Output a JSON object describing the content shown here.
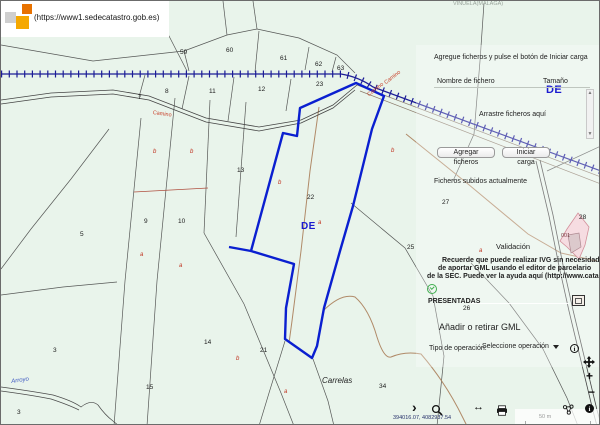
{
  "header": {
    "url": "(https://www1.sedecatastro.gob.es)",
    "area_label": "VIÑUELA(MALAGA)"
  },
  "upload_panel": {
    "instruction": "Agregue ficheros y pulse el botón de Iniciar carga",
    "file_table": {
      "name_header": "Nombre de fichero",
      "size_header": "Tamaño",
      "dropzone_text": "Arrastre ficheros aquí"
    },
    "add_files_button": "Agregar ficheros",
    "start_upload_button": "Iniciar carga",
    "uploaded_files_title": "Ficheros subidos actualmente",
    "validation_title": "Validación",
    "notice_lines": {
      "l1": "Recuerde que puede realizar IVG sin necesidad",
      "l2": "de aportar GML usando el editor de parcelario",
      "l3": "de la SEC. Puede ver la ayuda aquí (http://www.catastro.m"
    },
    "status_presented": "PRESENTADAS",
    "gml_section_title": "Añadir o retirar GML",
    "operation_type_label": "Tipo de operación:",
    "operation_select_value": "Seleccione operación"
  },
  "map": {
    "coordinates": "394016.07, 4082937.54",
    "scale_label": "50 m",
    "labels": [
      {
        "text": "59",
        "x": 179,
        "y": 49,
        "cls": "num"
      },
      {
        "text": "60",
        "x": 225,
        "y": 47,
        "cls": "num"
      },
      {
        "text": "61",
        "x": 279,
        "y": 55,
        "cls": "num"
      },
      {
        "text": "62",
        "x": 314,
        "y": 61,
        "cls": "num"
      },
      {
        "text": "63",
        "x": 336,
        "y": 65,
        "cls": "num"
      },
      {
        "text": "7",
        "x": 137,
        "y": 94,
        "cls": "num"
      },
      {
        "text": "8",
        "x": 164,
        "y": 88,
        "cls": "num"
      },
      {
        "text": "11",
        "x": 208,
        "y": 88,
        "cls": "num"
      },
      {
        "text": "12",
        "x": 257,
        "y": 86,
        "cls": "num"
      },
      {
        "text": "23",
        "x": 315,
        "y": 81,
        "cls": "num"
      },
      {
        "text": "13",
        "x": 236,
        "y": 167,
        "cls": "num"
      },
      {
        "text": "22",
        "x": 306,
        "y": 194,
        "cls": "num"
      },
      {
        "text": "9",
        "x": 143,
        "y": 218,
        "cls": "num"
      },
      {
        "text": "10",
        "x": 177,
        "y": 218,
        "cls": "num"
      },
      {
        "text": "5",
        "x": 79,
        "y": 231,
        "cls": "num"
      },
      {
        "text": "27",
        "x": 441,
        "y": 199,
        "cls": "num"
      },
      {
        "text": "25",
        "x": 406,
        "y": 244,
        "cls": "num"
      },
      {
        "text": "26",
        "x": 462,
        "y": 305,
        "cls": "num"
      },
      {
        "text": "28",
        "x": 578,
        "y": 214,
        "cls": "num"
      },
      {
        "text": "14",
        "x": 203,
        "y": 339,
        "cls": "num"
      },
      {
        "text": "15",
        "x": 145,
        "y": 384,
        "cls": "num"
      },
      {
        "text": "3",
        "x": 52,
        "y": 347,
        "cls": "num"
      },
      {
        "text": "3",
        "x": 16,
        "y": 409,
        "cls": "num"
      },
      {
        "text": "21",
        "x": 259,
        "y": 347,
        "cls": "num"
      },
      {
        "text": "34",
        "x": 378,
        "y": 383,
        "cls": "num"
      },
      {
        "text": "b",
        "x": 152,
        "y": 148,
        "cls": "red"
      },
      {
        "text": "b",
        "x": 189,
        "y": 148,
        "cls": "red"
      },
      {
        "text": "b",
        "x": 277,
        "y": 179,
        "cls": "red"
      },
      {
        "text": "b",
        "x": 390,
        "y": 147,
        "cls": "red"
      },
      {
        "text": "a",
        "x": 139,
        "y": 251,
        "cls": "red"
      },
      {
        "text": "a",
        "x": 178,
        "y": 262,
        "cls": "red"
      },
      {
        "text": "b",
        "x": 235,
        "y": 355,
        "cls": "red"
      },
      {
        "text": "a",
        "x": 283,
        "y": 388,
        "cls": "red"
      },
      {
        "text": "a",
        "x": 317,
        "y": 219,
        "cls": "red"
      },
      {
        "text": "a",
        "x": 478,
        "y": 247,
        "cls": "red"
      },
      {
        "text": "Camino",
        "x": 152,
        "y": 110,
        "cls": "road",
        "rot": 8
      },
      {
        "text": "Camino",
        "x": 383,
        "y": 81,
        "cls": "road",
        "rot": -38
      },
      {
        "text": "Camino",
        "x": 366,
        "y": 93,
        "cls": "road",
        "rot": -38
      },
      {
        "text": "DE",
        "x": 300,
        "y": 221,
        "cls": "de"
      },
      {
        "text": "DE",
        "x": 545,
        "y": 84,
        "cls": "de-lg"
      },
      {
        "text": "Arroyo",
        "x": 10,
        "y": 378,
        "cls": "arroyo",
        "rot": -8
      },
      {
        "text": "VIÑUELA(MALAGA)",
        "x": 452,
        "y": 1,
        "cls": "muted"
      },
      {
        "text": "001",
        "x": 560,
        "y": 233,
        "cls": "pink-num"
      },
      {
        "text": "Carrelas",
        "x": 321,
        "y": 376,
        "cls": "place"
      }
    ]
  },
  "colors": {
    "selected_parcel": "#0a1fd0",
    "railway": "#1c1c96",
    "map_background": "#e9f4eb",
    "pink_parcel": "#f3cdd5",
    "panel_text": "#222222"
  }
}
